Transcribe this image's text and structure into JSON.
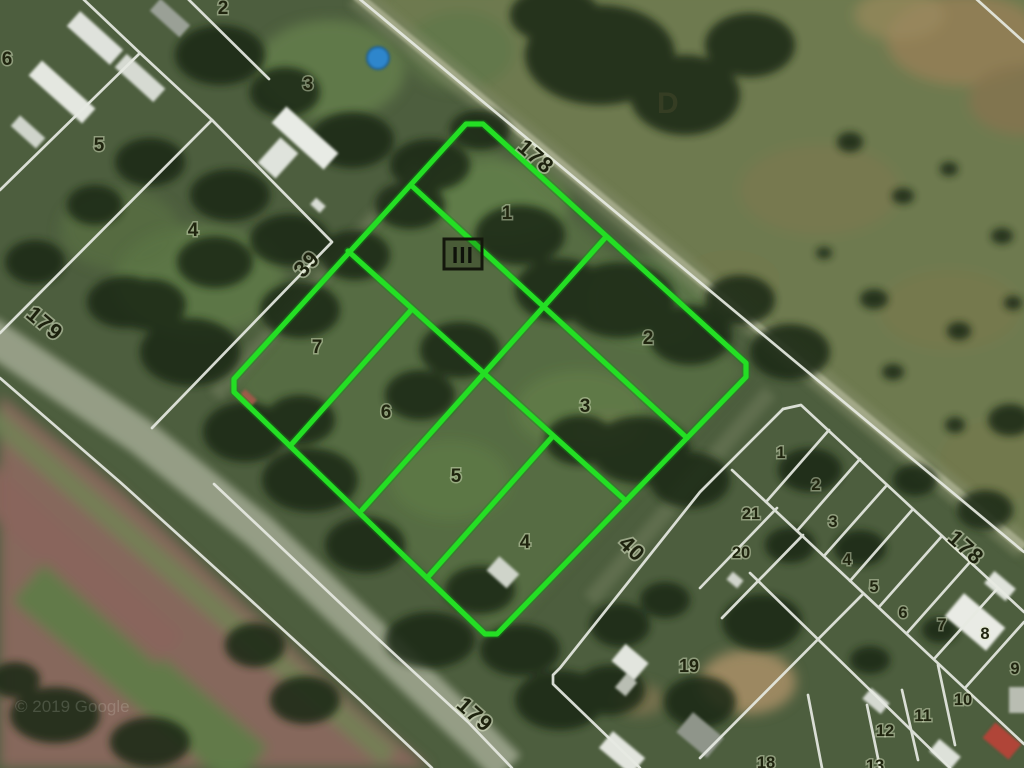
{
  "map": {
    "description": "Satellite cadastral map with a highlighted subdivision block of 7 lots",
    "watermark": "© 2019 Google",
    "district_label": "D",
    "block_marker": "III",
    "colors": {
      "highlight_green": "#24df24",
      "cadastral_white": "#e6eae2",
      "label_dark": "#20250f",
      "pool_blue": "#2f86cc",
      "road_gray": "#99a189"
    },
    "streets": {
      "s178_top": "178",
      "s178_right": "178",
      "s179_left": "179",
      "s179_bottom": "179",
      "s39": "39",
      "s40": "40"
    },
    "highlight_block": {
      "lots": [
        "1",
        "2",
        "3",
        "4",
        "5",
        "6",
        "7"
      ]
    },
    "west_block": {
      "lots": [
        "6",
        "5",
        "3",
        "4",
        "2"
      ]
    },
    "east_block": {
      "lots": [
        "1",
        "2",
        "21",
        "3",
        "20",
        "4",
        "5",
        "6",
        "7",
        "8",
        "9",
        "10",
        "11",
        "12",
        "13",
        "18",
        "19"
      ]
    }
  }
}
